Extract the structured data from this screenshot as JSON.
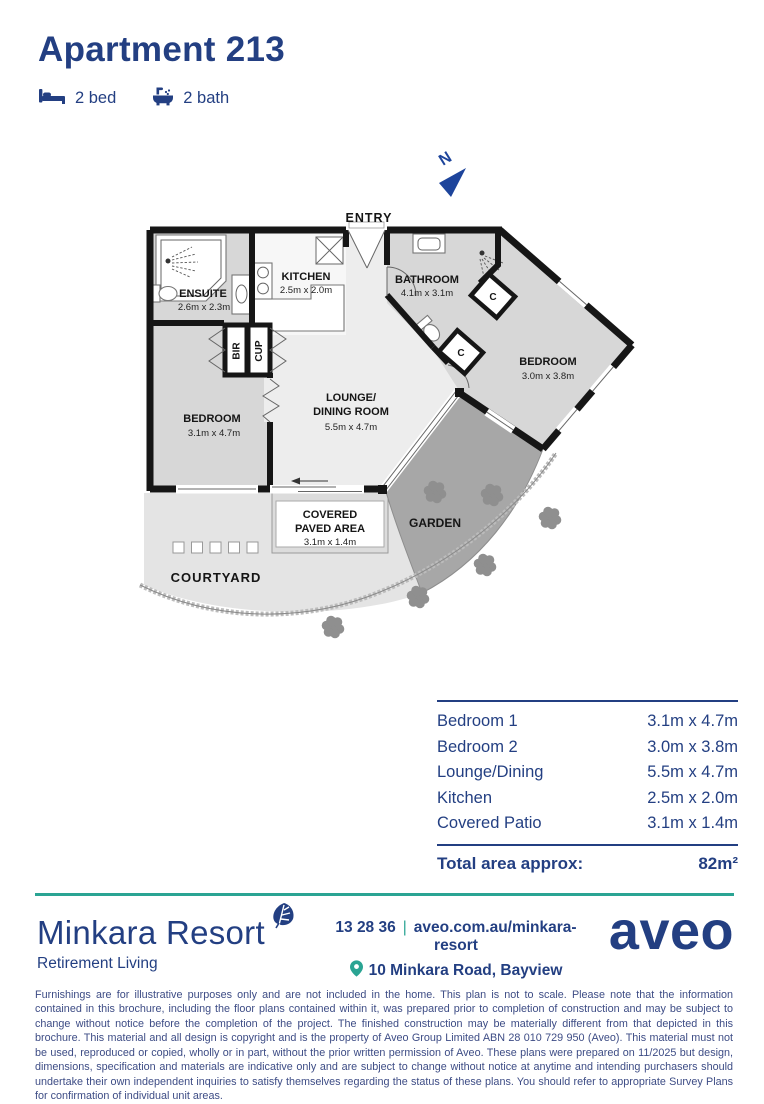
{
  "header": {
    "title": "Apartment 213",
    "bed_label": "2 bed",
    "bath_label": "2 bath"
  },
  "floor_plan": {
    "north_label": "N",
    "entry_label": "ENTRY",
    "rooms": {
      "ensuite": {
        "name": "ENSUITE",
        "dims": "2.6m x 2.3m"
      },
      "kitchen": {
        "name": "KITCHEN",
        "dims": "2.5m x 2.0m"
      },
      "bathroom": {
        "name": "BATHROOM",
        "dims": "4.1m x 3.1m"
      },
      "bedroom1": {
        "name": "BEDROOM",
        "dims": "3.1m x 4.7m"
      },
      "bedroom2": {
        "name": "BEDROOM",
        "dims": "3.0m x 3.8m"
      },
      "lounge": {
        "name_line1": "LOUNGE/",
        "name_line2": "DINING ROOM",
        "dims": "5.5m x 4.7m"
      },
      "covered_paved": {
        "name_line1": "COVERED",
        "name_line2": "PAVED AREA",
        "dims": "3.1m x 1.4m"
      },
      "garden": {
        "name": "GARDEN"
      },
      "courtyard": {
        "name": "COURTYARD"
      }
    },
    "storage": {
      "bir": "BIR",
      "cup": "CUP",
      "closet1": "C",
      "closet2": "C"
    }
  },
  "dimensions_table": {
    "rows": [
      {
        "label": "Bedroom 1",
        "value": "3.1m x 4.7m"
      },
      {
        "label": "Bedroom 2",
        "value": "3.0m x 3.8m"
      },
      {
        "label": "Lounge/Dining",
        "value": "5.5m x 4.7m"
      },
      {
        "label": "Kitchen",
        "value": "2.5m x 2.0m"
      },
      {
        "label": "Covered Patio",
        "value": "3.1m x 1.4m"
      }
    ],
    "total_label": "Total area approx:",
    "total_value": "82m²"
  },
  "footer": {
    "resort_name": "Minkara Resort",
    "tagline": "Retirement Living",
    "phone": "13 28 36",
    "separator": "|",
    "website": "aveo.com.au/minkara-resort",
    "address": "10 Minkara Road, Bayview",
    "brand": "aveo"
  },
  "disclaimer": "Furnishings are for illustrative purposes only and are not included in the home. This plan is not to scale. Please note that the information contained in this brochure, including the floor plans contained within it, was prepared prior to completion of construction and may be subject to change without notice before the completion of the project. The finished construction may be materially different from that depicted in this brochure. This material and all design is copyright and is the property of Aveo Group Limited ABN 28 010 729 950 (Aveo). This material must not be used, reproduced or copied, wholly or in part, without the prior written permission of Aveo. These plans were prepared on 11/2025 but design, dimensions, specification and materials are indicative only and are subject to change without notice at anytime and intending purchasers should undertake their own independent inquiries to satisfy themselves regarding the status of these plans. You should refer to appropriate Survey Plans for confirmation of individual unit areas.",
  "colors": {
    "navy": "#233f82",
    "teal": "#2aa493",
    "plan_blue": "#1d449b"
  }
}
